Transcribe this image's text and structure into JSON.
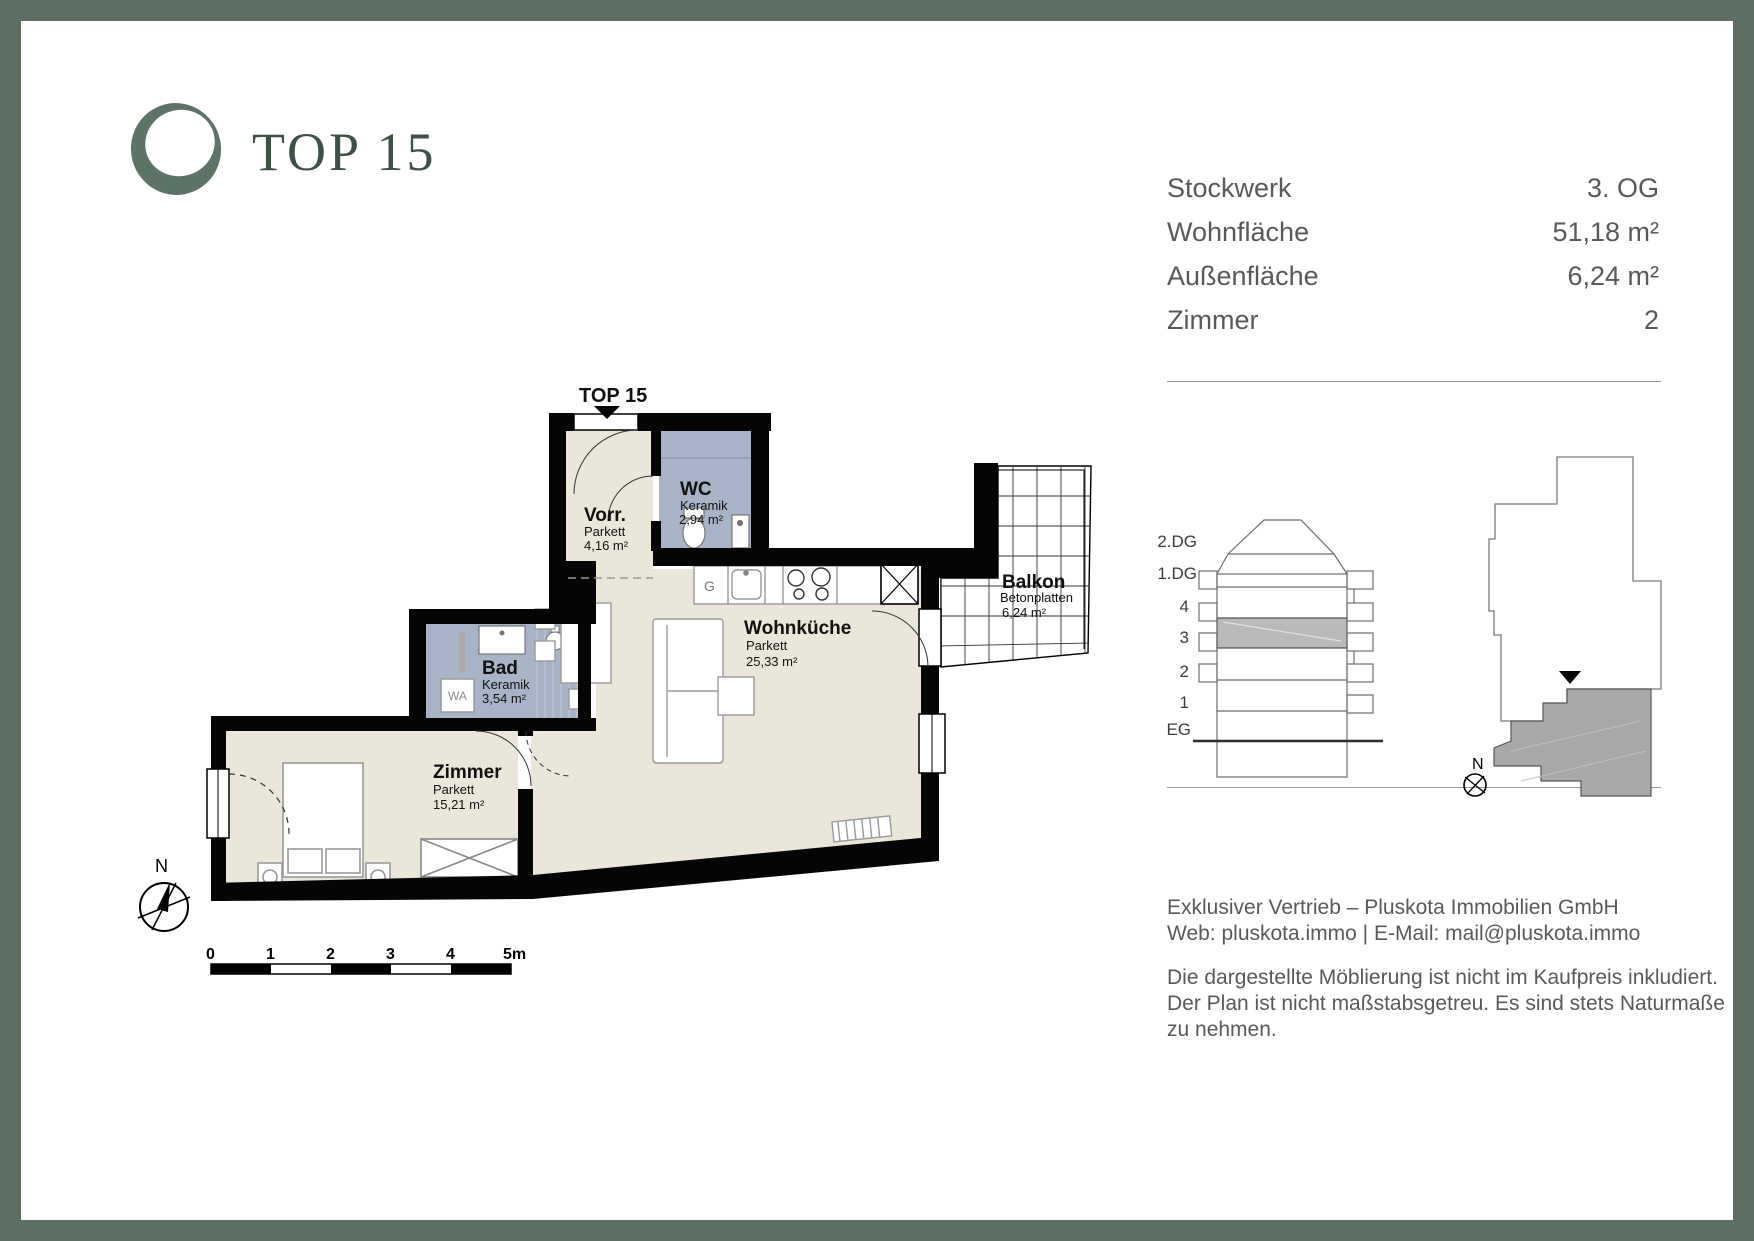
{
  "page": {
    "frame_color": "#5d6f62"
  },
  "logo": {
    "title": "TOP 15"
  },
  "info_table": {
    "rows": [
      {
        "label": "Stockwerk",
        "value": "3. OG"
      },
      {
        "label": "Wohnfläche",
        "value": "51,18 m²"
      },
      {
        "label": "Außenfläche",
        "value": "6,24 m²"
      },
      {
        "label": "Zimmer",
        "value": "2"
      }
    ]
  },
  "floorplan": {
    "unit_label": "TOP 15",
    "rooms": [
      {
        "name": "Vorr.",
        "material": "Parkett",
        "area": "4,16 m²"
      },
      {
        "name": "WC",
        "material": "Keramik",
        "area": "2,94 m²"
      },
      {
        "name": "Bad",
        "material": "Keramik",
        "area": "3,54 m²"
      },
      {
        "name": "Zimmer",
        "material": "Parkett",
        "area": "15,21 m²"
      },
      {
        "name": "Wohnküche",
        "material": "Parkett",
        "area": "25,33 m²"
      },
      {
        "name": "Balkon",
        "material": "Betonplatten",
        "area": "6,24 m²"
      }
    ],
    "labels": {
      "washer": "WA",
      "dishwasher": "G",
      "north": "N"
    },
    "scale_bar": {
      "ticks": [
        "0",
        "1",
        "2",
        "3",
        "4",
        "5m"
      ]
    }
  },
  "section_diagram": {
    "floor_labels": [
      "2.DG",
      "1.DG",
      "4",
      "3",
      "2",
      "1",
      "EG"
    ],
    "highlighted_floor": "3"
  },
  "site_plan": {
    "north": "N"
  },
  "footer": {
    "line1": "Exklusiver Vertrieb – Pluskota Immobilien GmbH",
    "line2": "Web: pluskota.immo | E-Mail: mail@pluskota.immo",
    "line3": "Die dargestellte Möblierung ist nicht im Kaufpreis inkludiert.",
    "line4": "Der Plan ist nicht maßstabsgetreu. Es sind stets Naturmaße",
    "line5": "zu nehmen."
  }
}
